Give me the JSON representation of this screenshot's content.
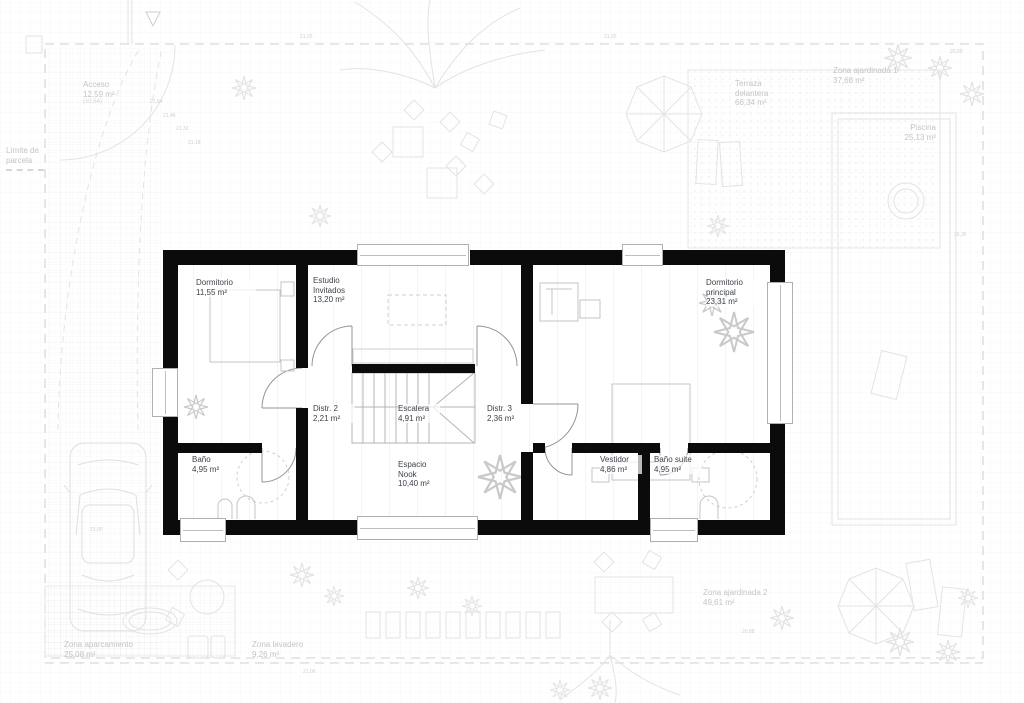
{
  "rooms": [
    {
      "id": "dormitorio",
      "label": "Dormitorio",
      "area": "11,55 m²"
    },
    {
      "id": "estudio_invitados",
      "label": "Estudio Invitados",
      "area": "13,20 m²"
    },
    {
      "id": "distribuidor_2",
      "label": "Distr. 2",
      "area": "2,21 m²"
    },
    {
      "id": "escalera",
      "label": "Escalera",
      "area": "4,91 m²"
    },
    {
      "id": "distribuidor_3",
      "label": "Distr. 3",
      "area": "2,36 m²"
    },
    {
      "id": "dormitorio_principal",
      "label": "Dormitorio principal",
      "area": "23,31 m²"
    },
    {
      "id": "bano",
      "label": "Baño",
      "area": "4,95 m²"
    },
    {
      "id": "espacio_nook",
      "label": "Espacio Nook",
      "area": "10,40 m²"
    },
    {
      "id": "vestidor",
      "label": "Vestidor",
      "area": "4,86 m²"
    },
    {
      "id": "bano_suite",
      "label": "Baño suite",
      "area": "4,95 m²"
    }
  ],
  "site": [
    {
      "id": "acceso",
      "label": "Acceso",
      "area": "12,59 m²",
      "level": "(±0,64)"
    },
    {
      "id": "limite_parcela",
      "label": "Límite de parcela"
    },
    {
      "id": "terraza_delantera",
      "label": "Terraza delantera",
      "area": "66,34 m²"
    },
    {
      "id": "zona_ajardinada_1",
      "label": "Zona ajardinada 1",
      "area": "37,68 m²"
    },
    {
      "id": "piscina",
      "label": "Piscina",
      "area": "25,13 m²"
    },
    {
      "id": "zona_aparcamiento",
      "label": "Zona aparcamiento",
      "area": "25,08 m²"
    },
    {
      "id": "zona_lavadero",
      "label": "Zona lavadero",
      "area": "9,26 m²"
    },
    {
      "id": "zona_ajardinada_2",
      "label": "Zona ajardinada 2",
      "area": "49,61 m²"
    }
  ],
  "dims": [
    "21,64",
    "21,46",
    "21,32",
    "21,18",
    "21,92",
    "21,92",
    "20,59",
    "26,36",
    "21,00",
    "20,88",
    "21,06"
  ],
  "colors": {
    "wall": "#0b0b0b",
    "room_label": "#3d424a",
    "site_label": "#c4c4c4",
    "site_line": "#e3e3e3",
    "door_arc": "#8f959c"
  }
}
